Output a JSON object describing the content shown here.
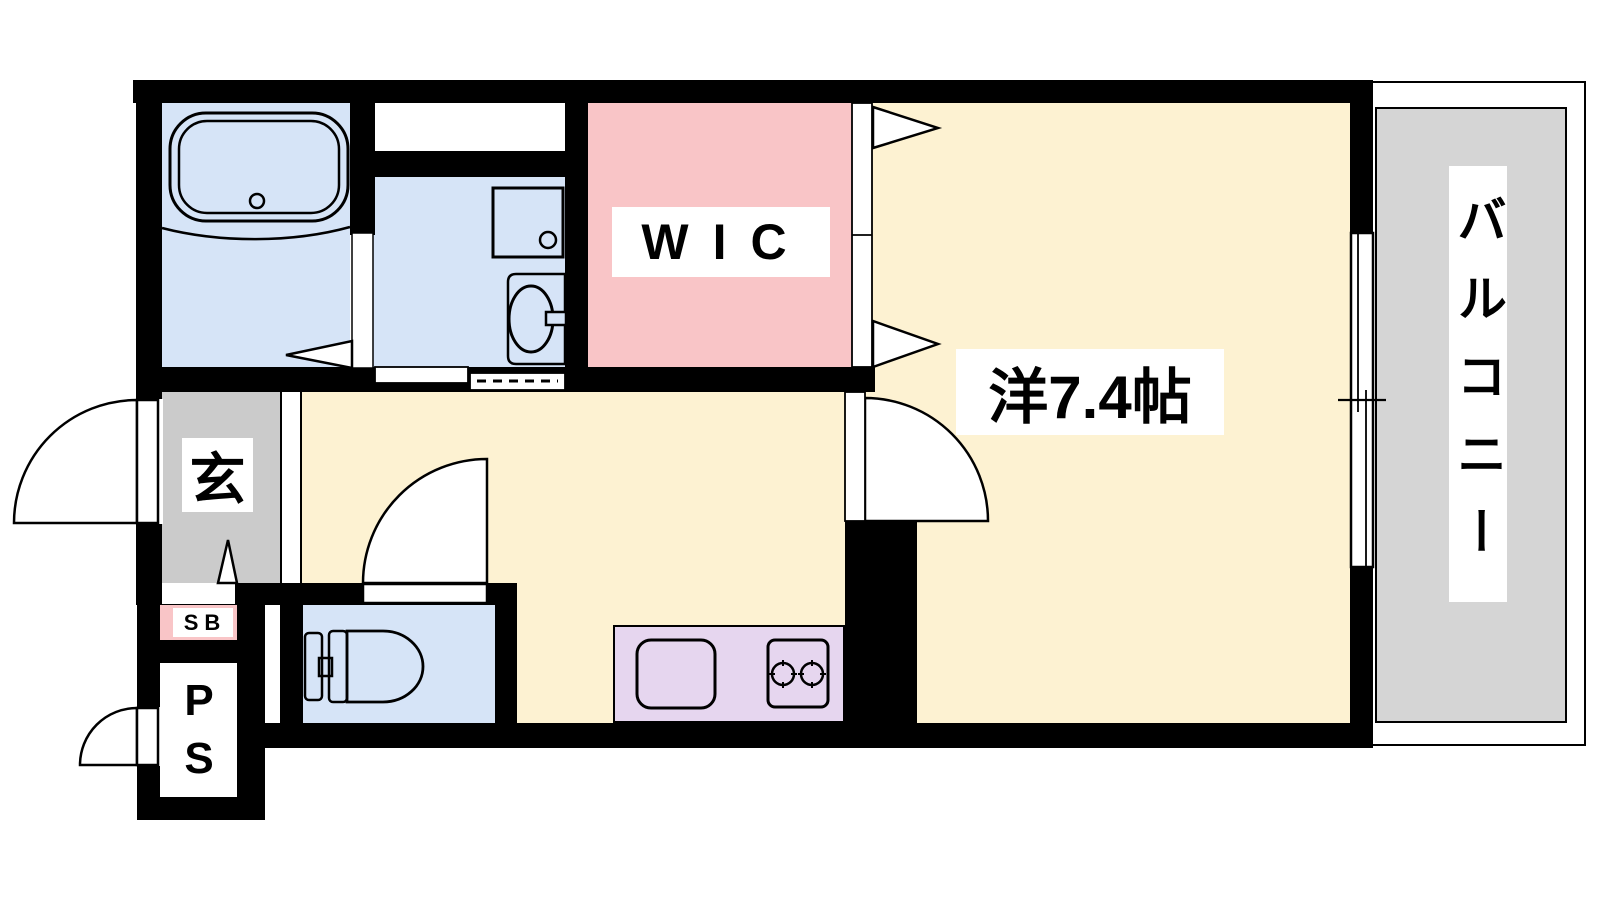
{
  "floorplan": {
    "labels": {
      "wic": "WIC",
      "main_room": "洋7.4帖",
      "balcony": "バルコニー",
      "entrance": "玄",
      "shoe_box": "SB",
      "pipe_space": "PS"
    },
    "colors": {
      "wall": "#000000",
      "wet_area": "#d6e4f7",
      "wic": "#f9c5c7",
      "room": "#fdf2d2",
      "kitchen_counter": "#e6d6ef",
      "entrance_floor": "#cbcbcb",
      "balcony_floor": "#d5d5d5",
      "shoe_box": "#f9c5c7",
      "label_bg": "#ffffff",
      "opening": "#ffffff"
    }
  }
}
